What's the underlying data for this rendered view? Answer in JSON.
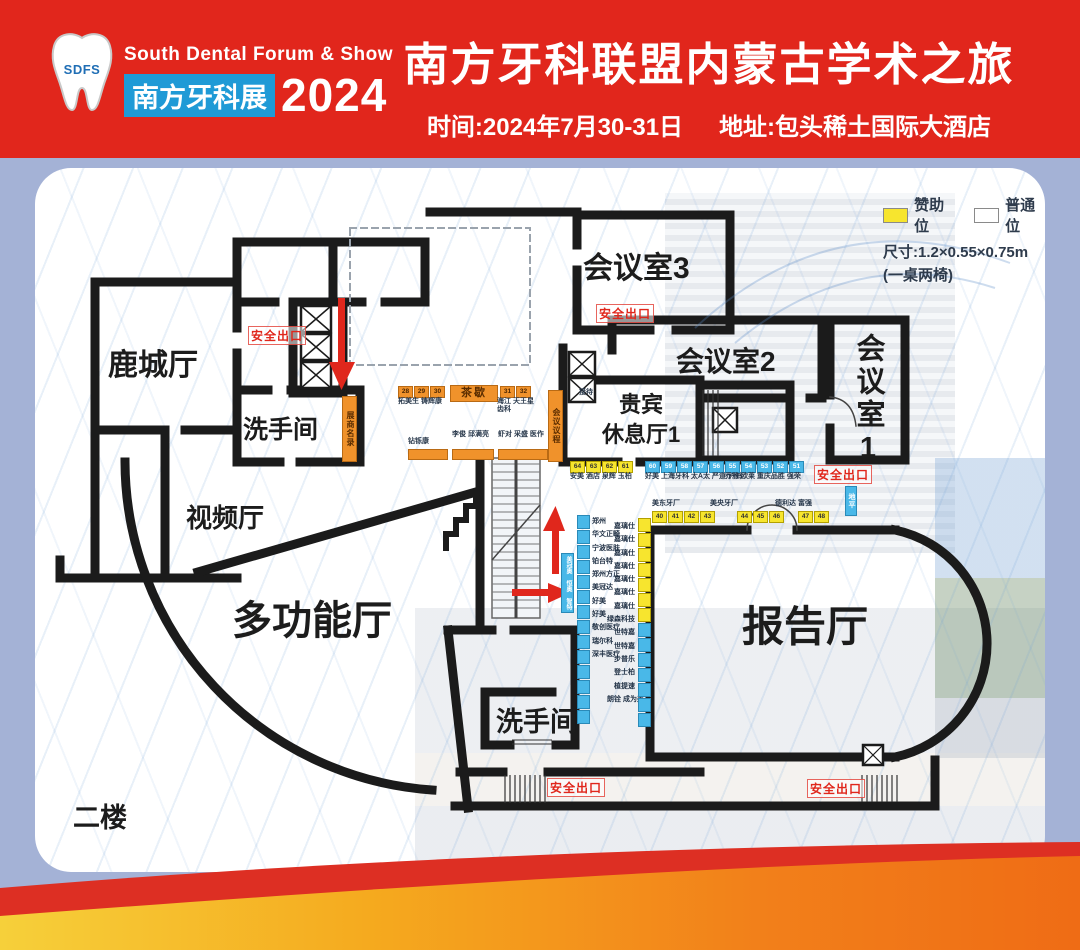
{
  "header": {
    "logo_acronym": "SDFS",
    "logo_line1": "South Dental Forum & Show",
    "logo_badge": "南方牙科展",
    "logo_year": "2024",
    "title": "南方牙科联盟内蒙古学术之旅",
    "subtitle_time": "时间:2024年7月30-31日",
    "subtitle_addr": "地址:包头稀土国际大酒店"
  },
  "legend": {
    "sponsor": "赞助位",
    "regular": "普通位",
    "size": "尺寸:1.2×0.55×0.75m",
    "note": "(一桌两椅)"
  },
  "floor_label": "二楼",
  "rooms": {
    "lucheng": "鹿城厅",
    "restroom_upper": "洗手间",
    "video": "视频厅",
    "multifunction": "多功能厅",
    "meeting3": "会议室3",
    "meeting2": "会议室2",
    "meeting1": "会议室1",
    "vip_line1": "贵宾",
    "vip_line2": "休息厅1",
    "lecture": "报告厅",
    "restroom_lower": "洗手间"
  },
  "signs": {
    "exit": "安全出口",
    "tea": "茶歇",
    "reception": "接待",
    "directory": "展商名录",
    "agenda": "会议议程"
  },
  "booths": {
    "top_row": {
      "nums": [
        "28",
        "29",
        "30"
      ],
      "label": "拓美生 铸辉康",
      "nums2": [
        "31",
        "32"
      ],
      "label2": "海江 天王星 齿科"
    },
    "mid_row": {
      "g1": "钻铄康",
      "g2": "李俊 邱满亮",
      "g3": "虾对 采盛 医作"
    },
    "vip_row": {
      "yellow_nums": [
        "64",
        "63",
        "62",
        "61"
      ],
      "yellow_label": "安美  酒店 泉辉 玉柏",
      "blue1_nums": [
        "60",
        "59",
        "58",
        "57",
        "56"
      ],
      "blue1_label": "好美 上海牙科 太A太 严道 沪鸽",
      "blue2_nums": [
        "55",
        "54",
        "53",
        "52",
        "51"
      ],
      "blue2_label": "乔雅 欧莱 重庆品胜 强荣"
    },
    "lecture_row": {
      "label_left": "美东牙厂",
      "label_mid": "美央牙厂",
      "label_right": "德利达 富强",
      "g1": [
        "40",
        "41",
        "42",
        "43"
      ],
      "g2": [
        "44",
        "45",
        "46"
      ],
      "g3": [
        "47",
        "48"
      ],
      "side_vertical": "地平"
    },
    "col_left": [
      "郑州",
      "华文正畸",
      "宁波医肤",
      "铂台特",
      "郑州方正",
      "美冠达",
      "好美",
      "好美",
      "敬创医疗",
      "瑞尔科",
      "深丰医疗"
    ],
    "col_mid": [
      "嘉璃仕",
      "嘉璃仕",
      "嘉璃仕",
      "嘉璃仕",
      "嘉璃仕",
      "嘉璃仕",
      "嘉璃仕",
      "绿森科技",
      "世特嘉",
      "世特嘉",
      "步普乐",
      "登士柏",
      "植提速",
      "朗铨 成为美"
    ],
    "escalator_side": "美冠奥 恒奥 智特"
  }
}
